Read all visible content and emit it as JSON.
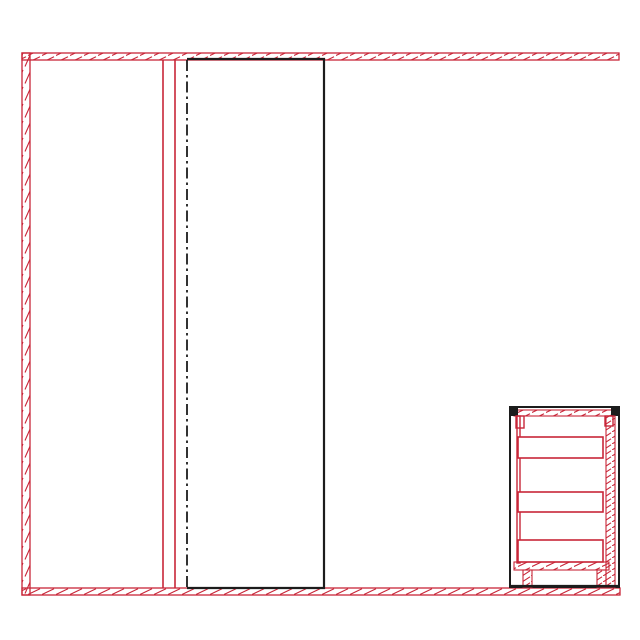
{
  "document": {
    "type": "cad-section-elevation-drawing",
    "description": "Interior elevation drawing: sectioned room walls in red hatch (top, left, floor), two red partition lines, black dash-dot centerline, open black wardrobe outline, and a three-drawer nightstand shown in section at the lower right.",
    "visible_text": []
  },
  "colors": {
    "background": "#ffffff",
    "red_pen": "#c82638",
    "black_pen": "#1c1c1c"
  },
  "walls": {
    "top_section": "hatched-red-band",
    "left_section": "hatched-red-band",
    "floor_section": "hatched-red-band"
  },
  "cabinet": {
    "name": "nightstand-section",
    "drawer_count": 3,
    "drawers": [
      {
        "x": 518,
        "y": 437,
        "w": 85,
        "h": 21
      },
      {
        "x": 518,
        "y": 492,
        "w": 85,
        "h": 20
      },
      {
        "x": 518,
        "y": 540,
        "w": 85,
        "h": 22
      }
    ]
  }
}
